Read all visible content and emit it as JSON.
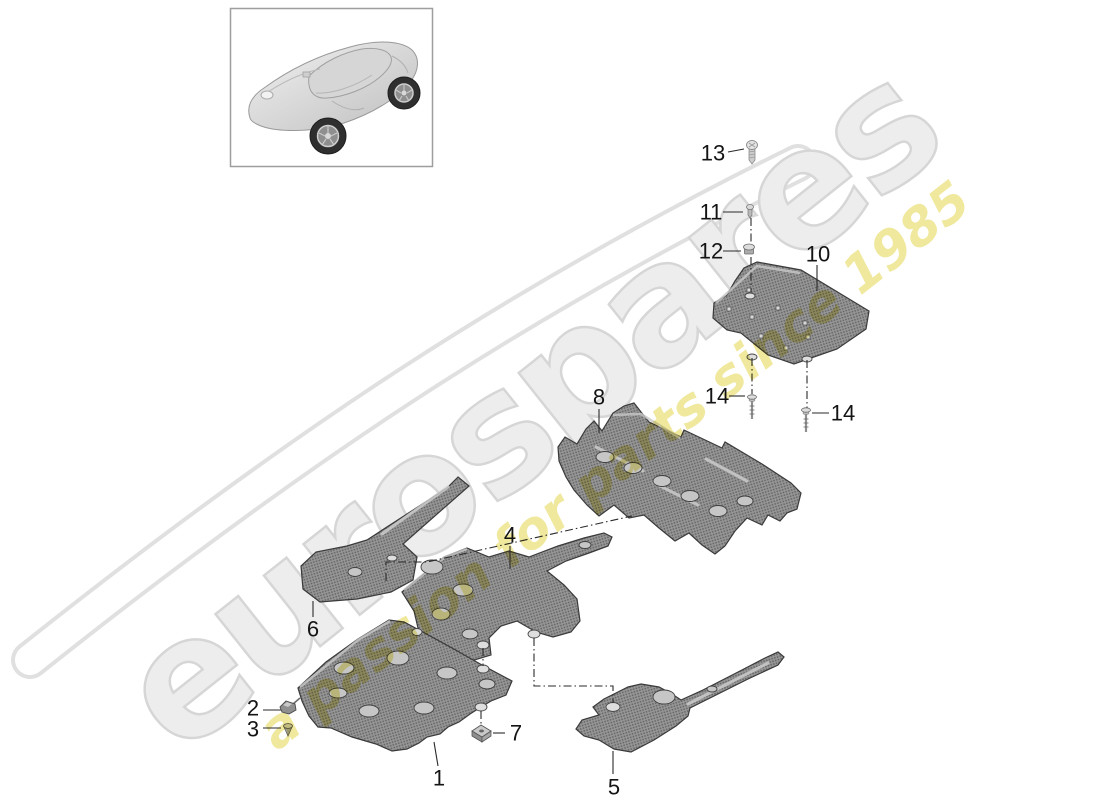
{
  "watermark": {
    "brand": "eurospares",
    "tagline": "a passion for parts since 1985",
    "brand_fill": "#ededed",
    "brand_outline_color": "#d6d6d6",
    "tagline_color": "#efe89d"
  },
  "diagram": {
    "type": "exploded-parts-diagram",
    "subject": "underbody trim panels",
    "panel_base_color": "#979797",
    "panel_dot_color": "#646464",
    "label_color": "#141414",
    "callouts": [
      {
        "label": "1"
      },
      {
        "label": "2"
      },
      {
        "label": "3"
      },
      {
        "label": "4"
      },
      {
        "label": "5"
      },
      {
        "label": "6"
      },
      {
        "label": "7"
      },
      {
        "label": "8"
      },
      {
        "label": "10"
      },
      {
        "label": "11"
      },
      {
        "label": "12"
      },
      {
        "label": "13"
      },
      {
        "label": "14"
      },
      {
        "label": "14"
      }
    ]
  }
}
